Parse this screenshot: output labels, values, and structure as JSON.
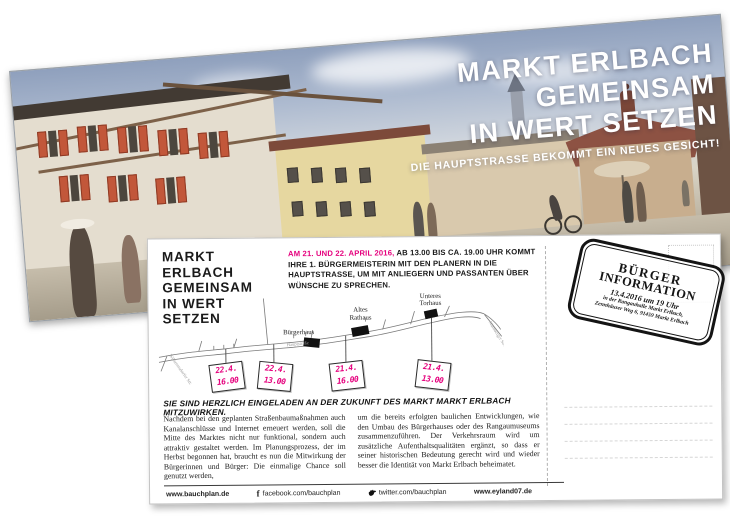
{
  "front_card": {
    "title_lines": [
      "MARKT ERLBACH",
      "GEMEINSAM",
      "IN WERT SETZEN"
    ],
    "subtitle": "DIE HAUPTSTRASSE BEKOMMT EIN NEUES GESICHT!"
  },
  "back_card": {
    "title_lines": [
      "MARKT ERLBACH",
      "GEMEINSAM",
      "IN WERT SETZEN"
    ],
    "intro_highlight": "AM 21. UND 22. APRIL 2016,",
    "intro_rest": " AB 13.00 BIS CA. 19.00 UHR KOMMT IHRE 1. BÜRGERMEISTERIN MIT DEN PLANERN IN DIE HAUPTSTRASSE, UM MIT ANLIEGERN UND PASSANTEN ÜBER WÜNSCHE ZU SPRECHEN.",
    "map": {
      "street_labels": [
        "Wilhermsdorfer Str.",
        "Hauptstraße",
        "Nürnberger Str."
      ],
      "buildings": [
        {
          "line1": "Bürgerhaus",
          "line2": ""
        },
        {
          "line1": "Altes",
          "line2": "Rathaus"
        },
        {
          "line1": "Unteres",
          "line2": "Torhaus"
        }
      ],
      "markers": [
        {
          "date": "22.4.",
          "time": "16.00"
        },
        {
          "date": "22.4.",
          "time": "13.00"
        },
        {
          "date": "21.4.",
          "time": "16.00"
        },
        {
          "date": "21.4.",
          "time": "13.00"
        }
      ]
    },
    "invitation": "SIE SIND HERZLICH EINGELADEN AN DER ZUKUNFT DES MARKT MARKT ERLBACH MITZUWIRKEN.",
    "body_columns": [
      "Nachdem bei den geplanten Straßenbaumaßnahmen auch Kanalanschlüsse und Internet erneuert werden, soll die Mitte des Marktes nicht nur funktional, sondern auch attraktiv gestaltet werden. Im Planungsprozess, der im Herbst begonnen hat, braucht es nun die Mitwirkung der Bürgerinnen und Bürger: Die einmalige Chance soll genutzt werden,",
      "um die bereits erfolgten baulichen Entwicklungen, wie den Umbau des Bürgerhauses oder des Rangaumuseums zusammenzuführen. Der Verkehrsraum wird um zusätzliche Aufenthaltsqualitäten ergänzt, so dass er seiner historischen Bedeutung gerecht wird und wieder besser die Identität von Markt Erlbach beheimatet."
    ],
    "footer": {
      "site1": "www.bauchplan.de",
      "facebook": "facebook.com/bauchplan",
      "twitter": "twitter.com/bauchplan",
      "site2": "www.eyland07.de"
    },
    "stamp": {
      "title1": "BÜRGER",
      "title2": "INFORMATION",
      "date": "13.4.2016 um 19 Uhr",
      "venue": "in der Rangauhalle Markt Erlbach,",
      "address": "Zennhäuser Weg 6, 91459 Markt Erlbach"
    }
  },
  "colors": {
    "magenta": "#e5007d",
    "ink": "#1a1a1a"
  }
}
